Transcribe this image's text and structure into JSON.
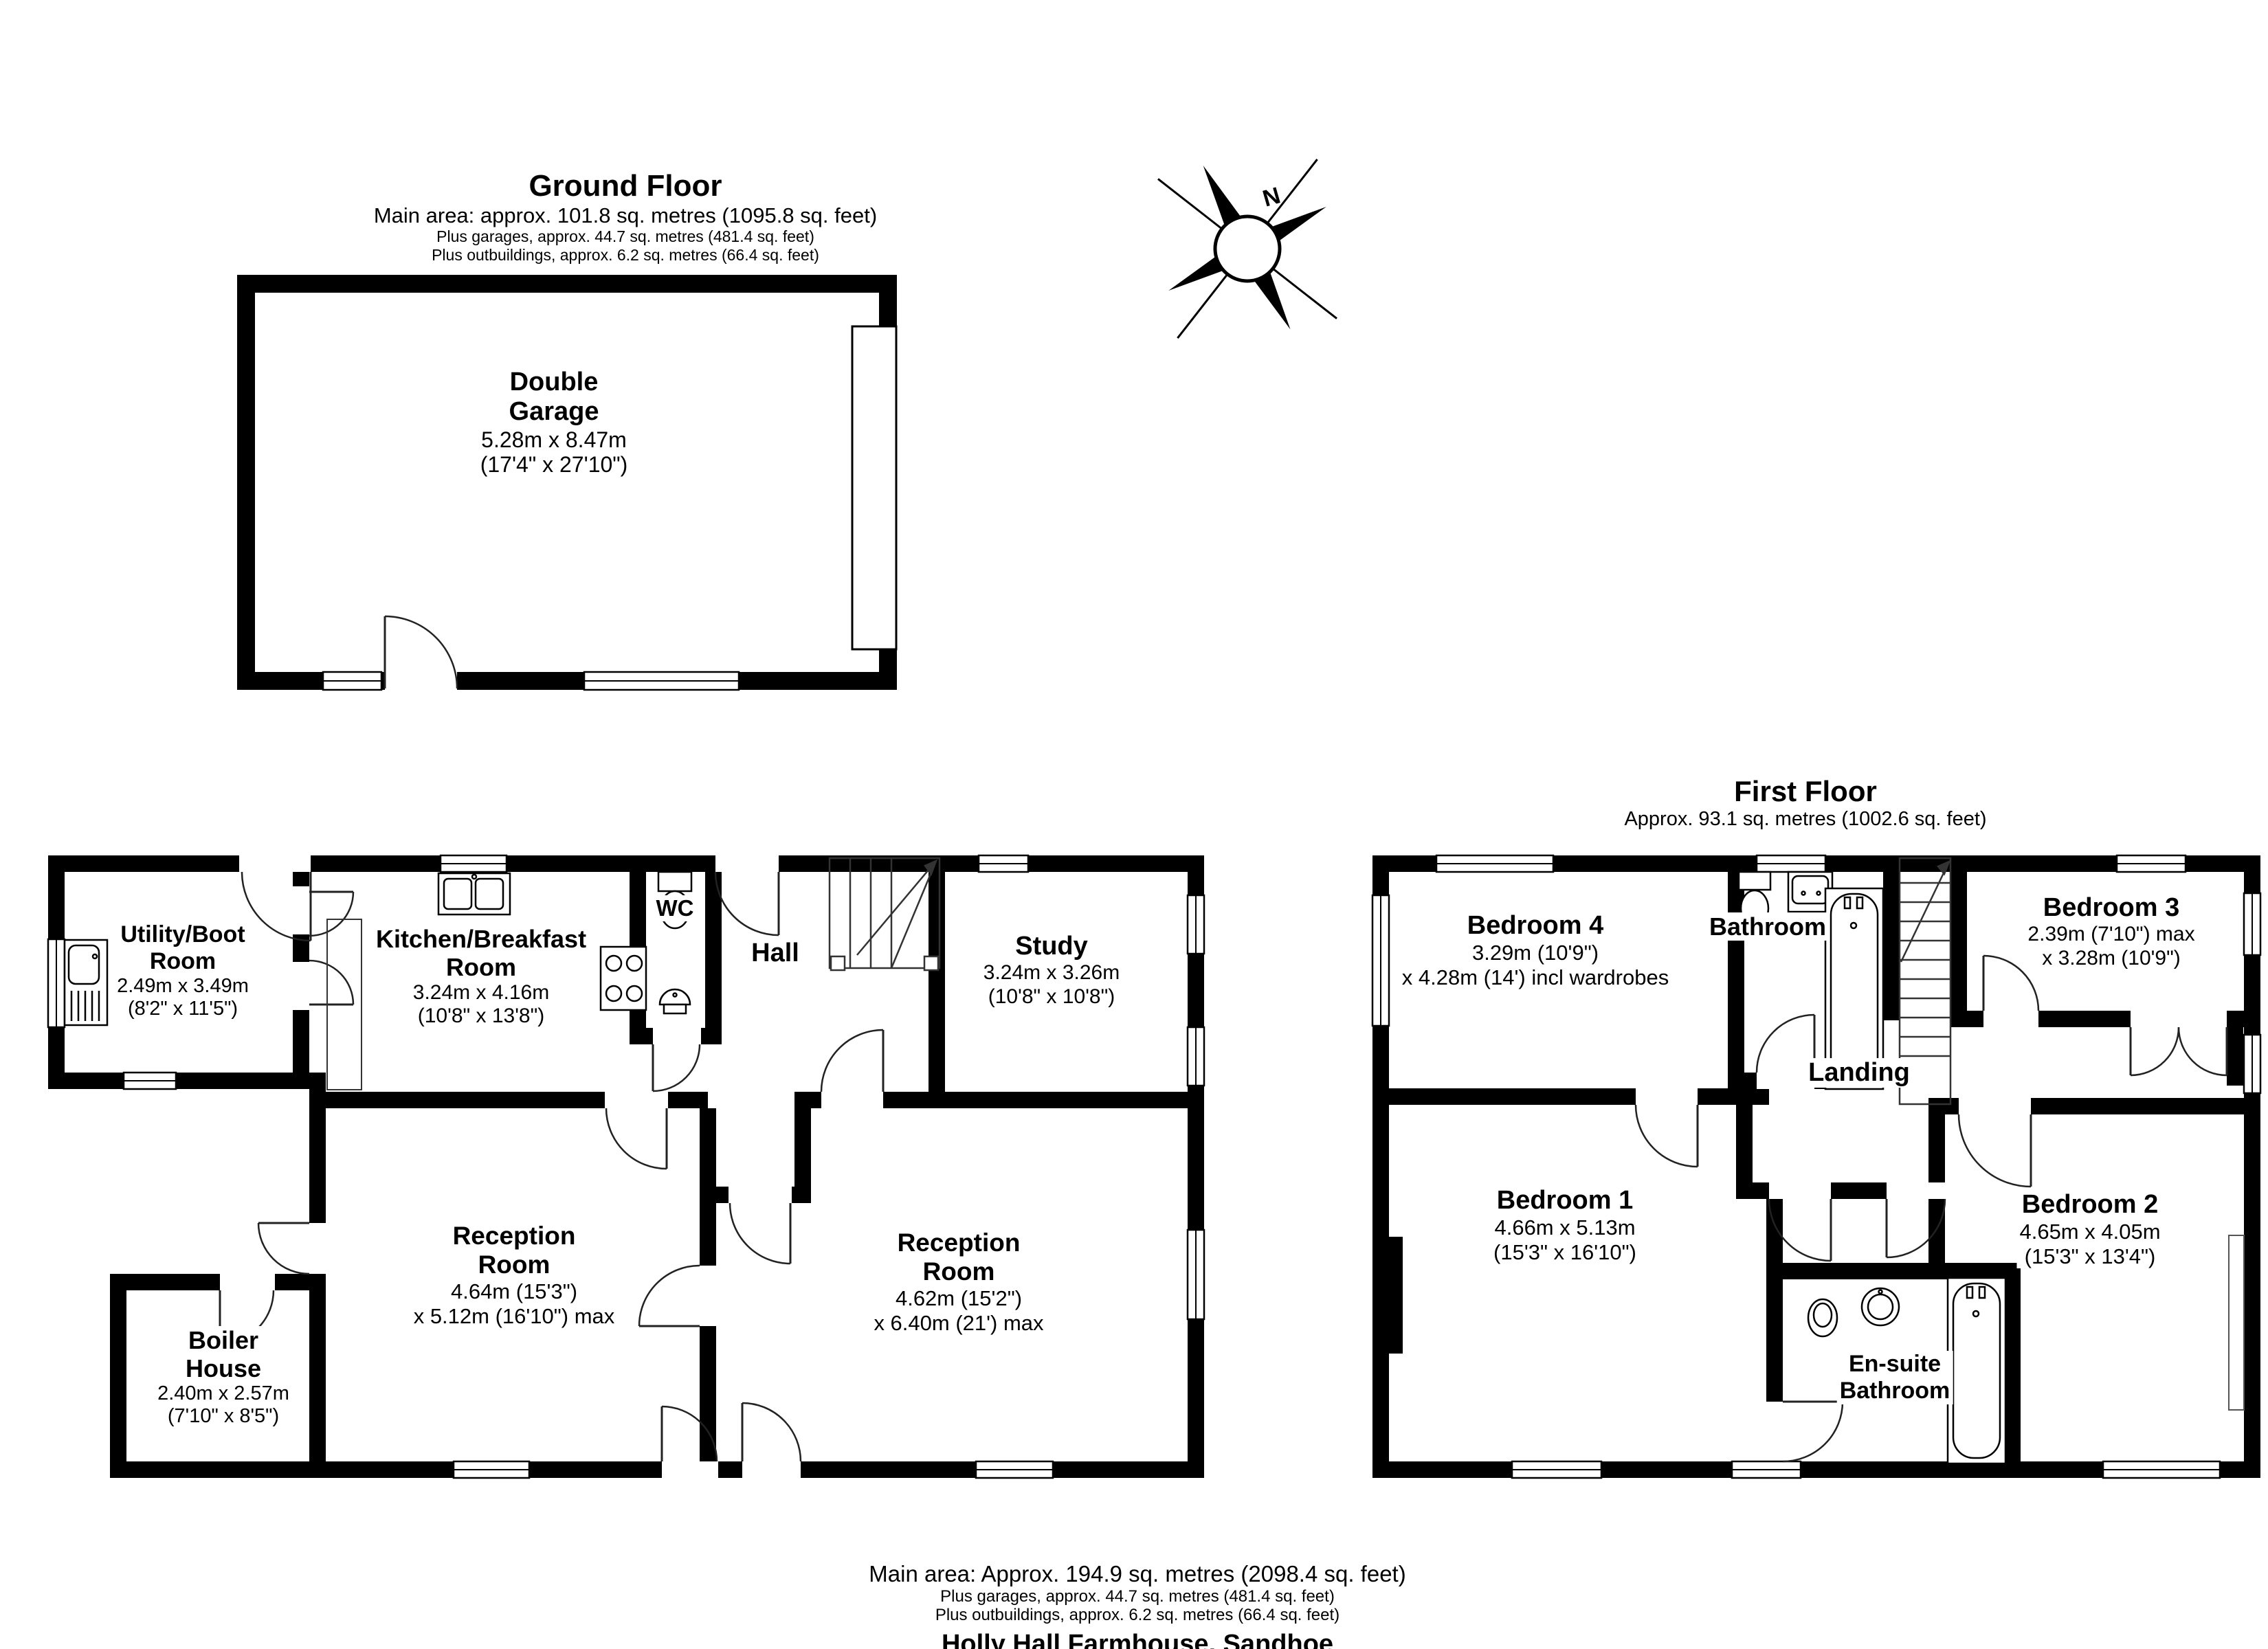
{
  "ground_floor": {
    "title": "Ground Floor",
    "area_line": "Main area: approx. 101.8 sq. metres (1095.8 sq. feet)",
    "garages_line": "Plus garages, approx. 44.7 sq. metres (481.4 sq. feet)",
    "outbuildings_line": "Plus outbuildings, approx. 6.2 sq. metres (66.4 sq. feet)",
    "rooms": {
      "garage": {
        "name1": "Double",
        "name2": "Garage",
        "dim1": "5.28m x 8.47m",
        "dim2": "(17'4\" x 27'10\")"
      },
      "utility": {
        "name1": "Utility/Boot",
        "name2": "Room",
        "dim1": "2.49m x 3.49m",
        "dim2": "(8'2\" x 11'5\")"
      },
      "kitchen": {
        "name1": "Kitchen/Breakfast",
        "name2": "Room",
        "dim1": "3.24m x 4.16m",
        "dim2": "(10'8\" x 13'8\")"
      },
      "wc": {
        "name1": "WC"
      },
      "hall": {
        "name1": "Hall"
      },
      "study": {
        "name1": "Study",
        "dim1": "3.24m x 3.26m",
        "dim2": "(10'8\" x 10'8\")"
      },
      "reception_left": {
        "name1": "Reception",
        "name2": "Room",
        "dim1": "4.64m (15'3\")",
        "dim2": "x 5.12m (16'10\") max"
      },
      "reception_right": {
        "name1": "Reception",
        "name2": "Room",
        "dim1": "4.62m (15'2\")",
        "dim2": "x 6.40m (21') max"
      },
      "boiler": {
        "name1": "Boiler",
        "name2": "House",
        "dim1": "2.40m x 2.57m",
        "dim2": "(7'10\" x 8'5\")"
      }
    }
  },
  "first_floor": {
    "title": "First Floor",
    "area_line": "Approx. 93.1 sq. metres (1002.6 sq. feet)",
    "rooms": {
      "bedroom4": {
        "name1": "Bedroom 4",
        "dim1": "3.29m (10'9\")",
        "dim2": "x 4.28m (14') incl wardrobes"
      },
      "bathroom": {
        "name1": "Bathroom"
      },
      "bedroom3": {
        "name1": "Bedroom 3",
        "dim1": "2.39m (7'10\") max",
        "dim2": "x 3.28m (10'9\")"
      },
      "landing": {
        "name1": "Landing"
      },
      "bedroom1": {
        "name1": "Bedroom 1",
        "dim1": "4.66m x 5.13m",
        "dim2": "(15'3\" x 16'10\")"
      },
      "bedroom2": {
        "name1": "Bedroom 2",
        "dim1": "4.65m x 4.05m",
        "dim2": "(15'3\" x 13'4\")"
      },
      "ensuite": {
        "name1": "En-suite",
        "name2": "Bathroom"
      }
    }
  },
  "compass": {
    "label": "N"
  },
  "footer": {
    "area_line": "Main area: Approx. 194.9 sq. metres (2098.4 sq. feet)",
    "garages_line": "Plus garages, approx. 44.7 sq. metres (481.4 sq. feet)",
    "outbuildings_line": "Plus outbuildings, approx. 6.2 sq. metres (66.4 sq. feet)",
    "property_name": "Holly Hall Farmhouse, Sandhoe"
  },
  "colors": {
    "wall": "#000000",
    "line": "#1a1a1a",
    "background": "#ffffff"
  }
}
